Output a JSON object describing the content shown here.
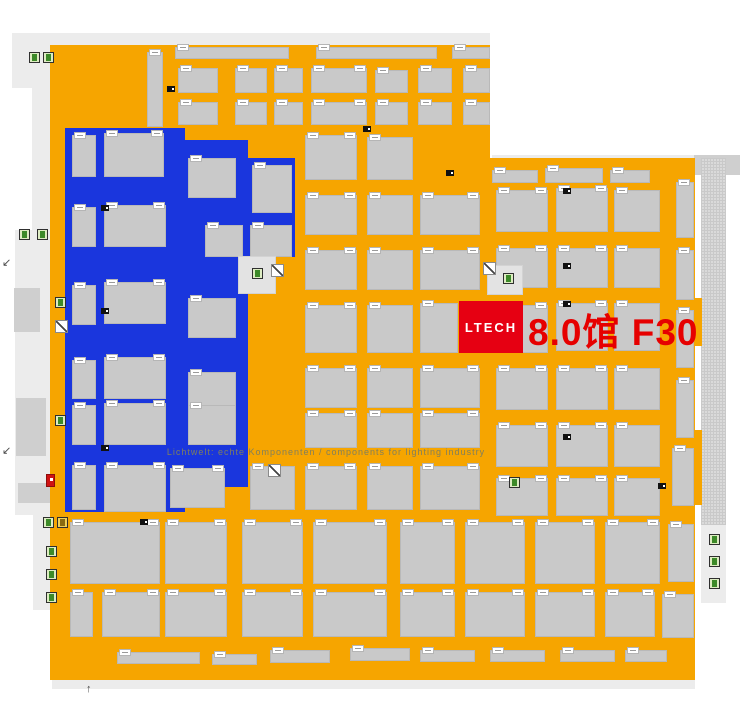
{
  "map": {
    "watermark": "Lichtwelt: echte Komponenten / components for lighting industry",
    "highlight": {
      "logo": "LTECH",
      "label": "8.0馆 F30",
      "logo_bg": "#E60012",
      "label_color": "#E60000"
    },
    "colors": {
      "orange": "#F6A500",
      "blue": "#1A36DD",
      "booth": "#C9C9C9",
      "corridor_light": "#ECECEC",
      "corridor_mid": "#CFCFCF",
      "hatch_bg": "#DADADA",
      "chip": "#FFFFFF"
    },
    "floors": {
      "light": [
        [
          12,
          33,
          478,
          12
        ],
        [
          12,
          33,
          38,
          55
        ],
        [
          492,
          155,
          248,
          14
        ],
        [
          32,
          45,
          18,
          185
        ],
        [
          15,
          230,
          35,
          285
        ],
        [
          33,
          515,
          27,
          95
        ],
        [
          52,
          680,
          643,
          9
        ],
        [
          701,
          523,
          25,
          80
        ]
      ],
      "mid": [
        [
          694,
          155,
          46,
          20
        ],
        [
          14,
          288,
          26,
          44
        ],
        [
          16,
          398,
          30,
          58
        ],
        [
          18,
          483,
          38,
          20
        ]
      ],
      "hatch": [
        [
          701,
          158,
          25,
          367
        ]
      ],
      "orange": [
        [
          50,
          45,
          440,
          635
        ],
        [
          490,
          158,
          205,
          522
        ],
        [
          695,
          298,
          7,
          48
        ],
        [
          695,
          430,
          7,
          75
        ]
      ],
      "blue": [
        [
          65,
          128,
          120,
          384
        ],
        [
          185,
          140,
          63,
          347
        ],
        [
          248,
          158,
          47,
          99
        ]
      ]
    },
    "booths": {
      "orange": [
        [
          147,
          52,
          16,
          75
        ],
        [
          175,
          47,
          114,
          12
        ],
        [
          316,
          47,
          121,
          12
        ],
        [
          452,
          47,
          38,
          12
        ],
        [
          178,
          68,
          40,
          25
        ],
        [
          235,
          68,
          32,
          25
        ],
        [
          274,
          68,
          29,
          25
        ],
        [
          311,
          68,
          56,
          25
        ],
        [
          375,
          70,
          33,
          23
        ],
        [
          418,
          68,
          34,
          25
        ],
        [
          463,
          68,
          27,
          25
        ],
        [
          178,
          102,
          40,
          23
        ],
        [
          235,
          102,
          32,
          23
        ],
        [
          274,
          102,
          29,
          23
        ],
        [
          311,
          102,
          56,
          23
        ],
        [
          375,
          102,
          33,
          23
        ],
        [
          418,
          102,
          34,
          23
        ],
        [
          463,
          102,
          27,
          23
        ],
        [
          305,
          135,
          52,
          45
        ],
        [
          367,
          137,
          46,
          43
        ],
        [
          305,
          195,
          52,
          40
        ],
        [
          367,
          195,
          46,
          40
        ],
        [
          420,
          195,
          60,
          40
        ],
        [
          305,
          250,
          52,
          40
        ],
        [
          367,
          250,
          46,
          40
        ],
        [
          420,
          250,
          60,
          40
        ],
        [
          305,
          305,
          52,
          48
        ],
        [
          367,
          305,
          46,
          48
        ],
        [
          420,
          303,
          38,
          50
        ],
        [
          305,
          368,
          52,
          40
        ],
        [
          367,
          368,
          46,
          40
        ],
        [
          420,
          368,
          60,
          40
        ],
        [
          305,
          413,
          52,
          35
        ],
        [
          367,
          413,
          46,
          35
        ],
        [
          420,
          413,
          60,
          35
        ],
        [
          250,
          466,
          45,
          44
        ],
        [
          305,
          466,
          52,
          44
        ],
        [
          367,
          466,
          46,
          44
        ],
        [
          420,
          466,
          60,
          44
        ],
        [
          492,
          170,
          46,
          13
        ],
        [
          545,
          168,
          58,
          15
        ],
        [
          610,
          170,
          40,
          13
        ],
        [
          676,
          182,
          18,
          56
        ],
        [
          676,
          250,
          18,
          50
        ],
        [
          676,
          310,
          18,
          58
        ],
        [
          676,
          380,
          18,
          58
        ],
        [
          672,
          448,
          22,
          58
        ],
        [
          496,
          190,
          52,
          42
        ],
        [
          556,
          188,
          52,
          44
        ],
        [
          614,
          190,
          46,
          42
        ],
        [
          496,
          248,
          52,
          40
        ],
        [
          556,
          248,
          52,
          40
        ],
        [
          614,
          248,
          46,
          40
        ],
        [
          496,
          305,
          52,
          48
        ],
        [
          556,
          303,
          52,
          48
        ],
        [
          614,
          303,
          46,
          48
        ],
        [
          496,
          368,
          52,
          42
        ],
        [
          556,
          368,
          52,
          42
        ],
        [
          614,
          368,
          46,
          42
        ],
        [
          496,
          425,
          52,
          42
        ],
        [
          556,
          425,
          52,
          42
        ],
        [
          614,
          425,
          46,
          42
        ],
        [
          496,
          478,
          52,
          38
        ],
        [
          556,
          478,
          52,
          38
        ],
        [
          614,
          478,
          46,
          38
        ],
        [
          70,
          522,
          90,
          62
        ],
        [
          165,
          522,
          62,
          62
        ],
        [
          242,
          522,
          61,
          62
        ],
        [
          313,
          522,
          74,
          62
        ],
        [
          400,
          522,
          55,
          62
        ],
        [
          465,
          522,
          60,
          62
        ],
        [
          535,
          522,
          60,
          62
        ],
        [
          605,
          522,
          55,
          62
        ],
        [
          668,
          524,
          26,
          58
        ],
        [
          70,
          592,
          23,
          45
        ],
        [
          102,
          592,
          58,
          45
        ],
        [
          165,
          592,
          62,
          45
        ],
        [
          242,
          592,
          61,
          45
        ],
        [
          313,
          592,
          74,
          45
        ],
        [
          400,
          592,
          55,
          45
        ],
        [
          465,
          592,
          60,
          45
        ],
        [
          535,
          592,
          60,
          45
        ],
        [
          605,
          592,
          50,
          45
        ],
        [
          662,
          594,
          32,
          44
        ],
        [
          117,
          652,
          83,
          12
        ],
        [
          212,
          654,
          45,
          11
        ],
        [
          270,
          650,
          60,
          13
        ],
        [
          350,
          648,
          60,
          13
        ],
        [
          420,
          650,
          55,
          12
        ],
        [
          490,
          650,
          55,
          12
        ],
        [
          560,
          650,
          55,
          12
        ],
        [
          625,
          650,
          42,
          12
        ]
      ],
      "blue": [
        [
          72,
          135,
          24,
          42
        ],
        [
          104,
          133,
          60,
          44
        ],
        [
          188,
          158,
          48,
          40
        ],
        [
          252,
          165,
          40,
          48
        ],
        [
          72,
          207,
          24,
          40
        ],
        [
          104,
          205,
          62,
          42
        ],
        [
          205,
          225,
          38,
          32
        ],
        [
          250,
          225,
          42,
          32
        ],
        [
          72,
          285,
          24,
          40
        ],
        [
          104,
          282,
          62,
          42
        ],
        [
          188,
          298,
          48,
          40
        ],
        [
          72,
          360,
          24,
          39
        ],
        [
          104,
          357,
          62,
          42
        ],
        [
          188,
          372,
          48,
          40
        ],
        [
          72,
          405,
          24,
          40
        ],
        [
          104,
          403,
          62,
          42
        ],
        [
          188,
          405,
          48,
          40
        ],
        [
          72,
          465,
          24,
          45
        ],
        [
          104,
          465,
          62,
          47
        ],
        [
          170,
          468,
          55,
          40
        ]
      ]
    },
    "pads": [
      [
        238,
        256,
        38,
        38
      ],
      [
        487,
        265,
        36,
        30
      ]
    ],
    "icons": {
      "green": [
        [
          29,
          52
        ],
        [
          43,
          52
        ],
        [
          19,
          229
        ],
        [
          37,
          229
        ],
        [
          55,
          297
        ],
        [
          55,
          415
        ],
        [
          43,
          517
        ],
        [
          46,
          546
        ],
        [
          46,
          569
        ],
        [
          46,
          592
        ],
        [
          252,
          268
        ],
        [
          503,
          273
        ],
        [
          509,
          477
        ],
        [
          709,
          534
        ],
        [
          709,
          556
        ],
        [
          709,
          578
        ]
      ],
      "yellow": [
        [
          57,
          517
        ]
      ],
      "red": [
        [
          46,
          474
        ]
      ],
      "diag": [
        [
          55,
          320
        ],
        [
          271,
          264
        ],
        [
          483,
          262
        ],
        [
          268,
          464
        ]
      ]
    },
    "door_markers": [
      [
        101,
        205
      ],
      [
        101,
        308
      ],
      [
        101,
        445
      ],
      [
        140,
        519
      ],
      [
        167,
        86
      ],
      [
        363,
        126
      ],
      [
        446,
        170
      ],
      [
        563,
        188
      ],
      [
        563,
        263
      ],
      [
        563,
        301
      ],
      [
        563,
        434
      ],
      [
        658,
        483
      ]
    ],
    "arrows": [
      {
        "x": 2,
        "y": 258,
        "glyph": "↙"
      },
      {
        "x": 2,
        "y": 446,
        "glyph": "↙"
      },
      {
        "x": 86,
        "y": 684,
        "glyph": "↑"
      }
    ]
  }
}
